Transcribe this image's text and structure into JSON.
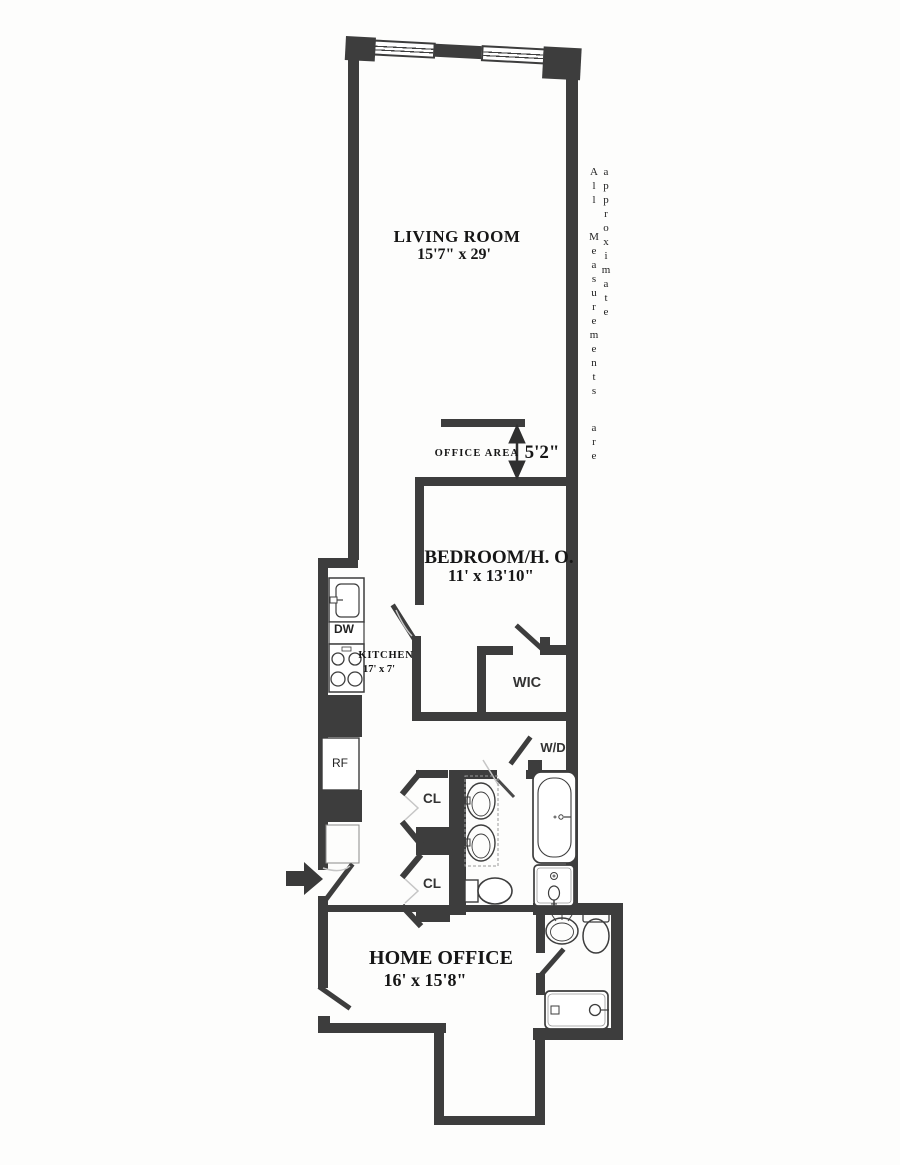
{
  "note": "All Measurements are approximate",
  "rooms": {
    "living_room": {
      "name": "LIVING ROOM",
      "dims": "15'7\" x 29'"
    },
    "office_area": {
      "name": "OFFICE AREA",
      "dim": "5'2\""
    },
    "bedroom": {
      "name": "BEDROOM/H. O.",
      "dims": "11' x 13'10\""
    },
    "kitchen": {
      "name": "KITCHEN",
      "dims": "17' x 7'"
    },
    "home_office": {
      "name": "HOME OFFICE",
      "dims": "16' x 15'8\""
    },
    "wic": "WIC",
    "wd": "W/D",
    "closet1": "CL",
    "closet2": "CL",
    "dishwasher": "DW",
    "refrigerator": "RF"
  },
  "colors": {
    "wall": "#3d3d3d",
    "text": "#161616"
  }
}
